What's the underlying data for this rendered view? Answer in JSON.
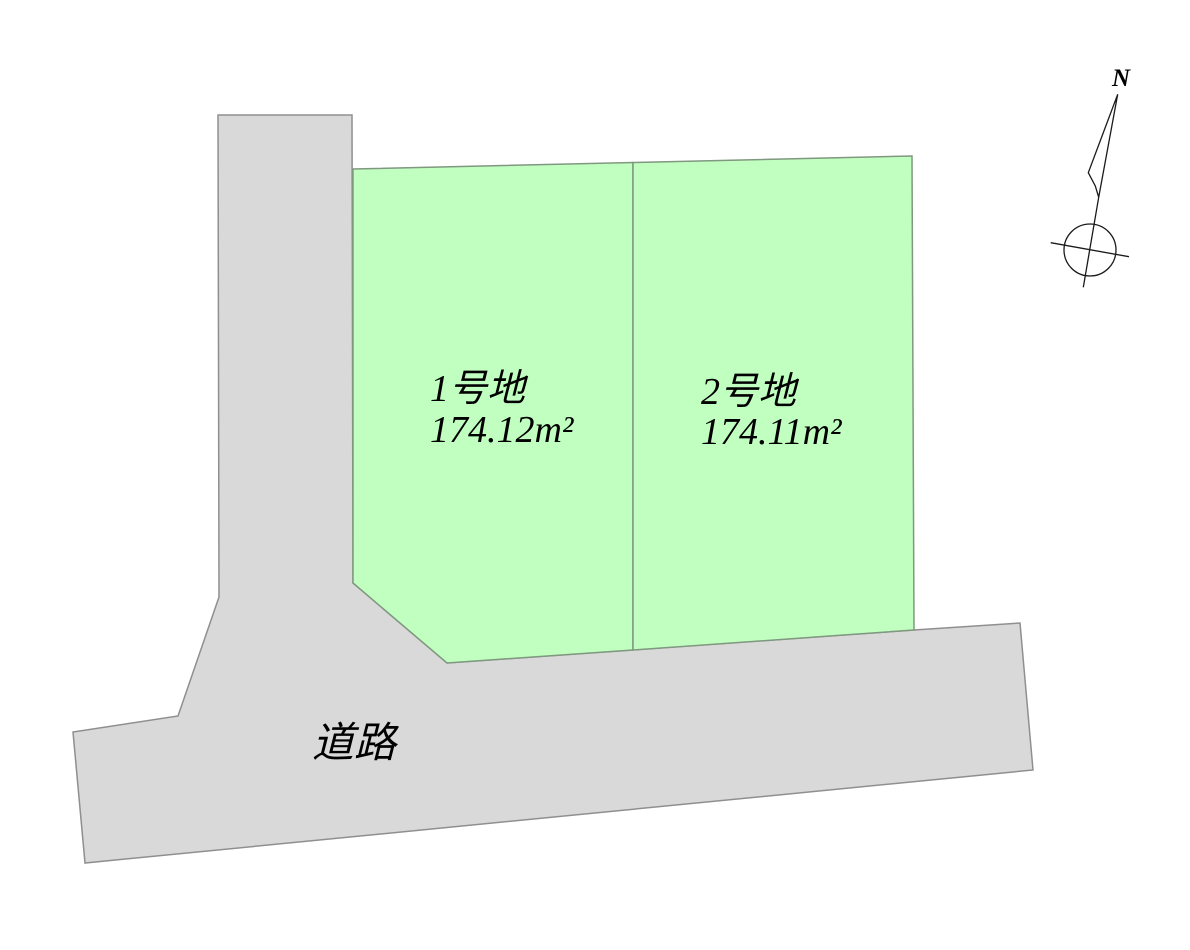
{
  "diagram": {
    "title": "land subdivision site plan",
    "plots": [
      {
        "name": "1号地",
        "area": "174.12m²"
      },
      {
        "name": "2号地",
        "area": "174.11m²"
      }
    ],
    "road_label": "道路",
    "compass_label": "N"
  },
  "colors": {
    "plot_fill": "#c1ffc1",
    "plot_stroke": "#7f987f",
    "road_fill": "#d9d9d9",
    "road_stroke": "#8f8f8f",
    "compass_line": "#1a1a1a",
    "text": "#000000",
    "background": "#ffffff"
  }
}
